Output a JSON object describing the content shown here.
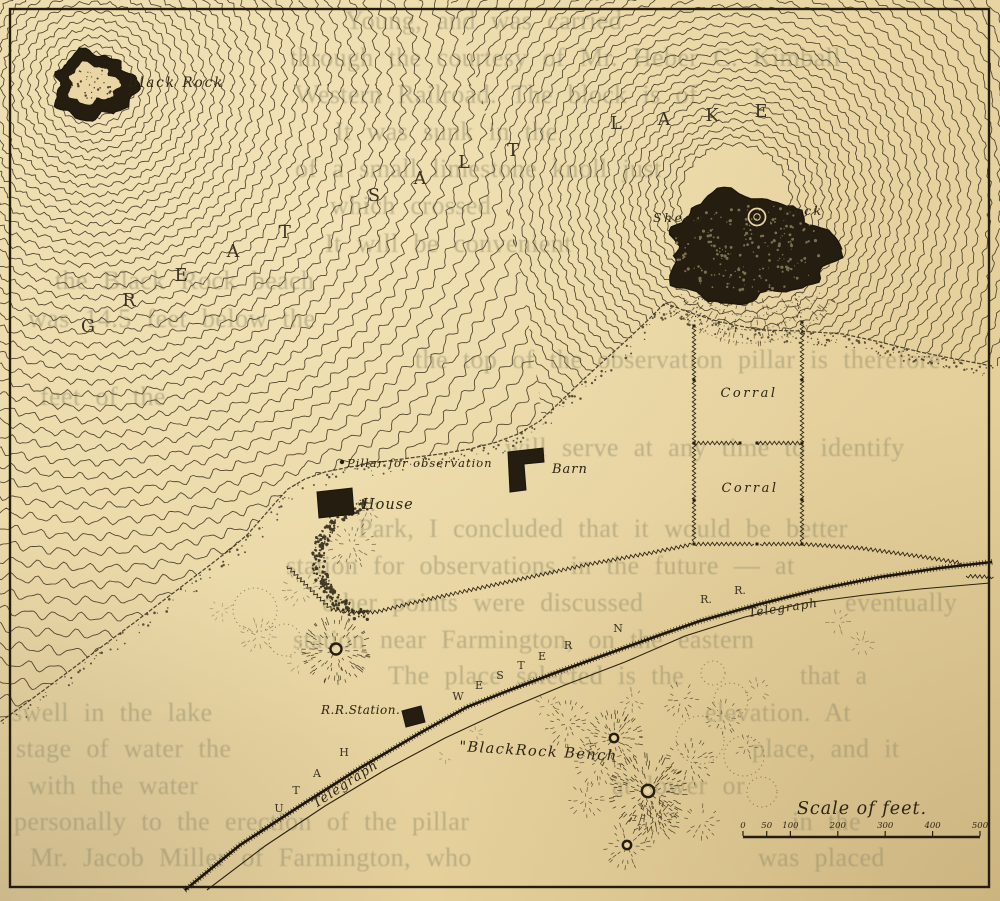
{
  "map": {
    "lake_name": "GREAT SALT LAKE",
    "labels": {
      "black_rock": "Black Rock",
      "sheep_rock_left": "Sheep",
      "sheep_rock_right": "Rock",
      "corral_upper": "Corral",
      "corral_lower": "Corral",
      "pillar": "Pillar for observation",
      "barn": "Barn",
      "house": "House",
      "rr_station": "R.R.Station.",
      "railroad_name": "UTAH WESTERN R.R.",
      "telegraph_lower": "Telegraph",
      "telegraph_upper": "Telegraph",
      "black_rock_bench": "\"BlackRock Bench",
      "scale_title": "Scale of feet."
    },
    "scale_bar": {
      "tick_labels": [
        "0",
        "50",
        "100",
        "200",
        "300",
        "400",
        "500"
      ]
    },
    "colors": {
      "paper": "#e9d6a4",
      "ink": "#38301f",
      "ghost_text": "#8f8a68"
    }
  },
  "bleedthrough_text": [
    {
      "x": 345,
      "y": 6,
      "text": "Young, and was carried"
    },
    {
      "x": 290,
      "y": 43,
      "text": "through the courtesy of Mr. Heber C. Kimball"
    },
    {
      "x": 295,
      "y": 80,
      "text": "Western Railroad.  The block is of"
    },
    {
      "x": 335,
      "y": 117,
      "text": "It was sunk in the"
    },
    {
      "x": 295,
      "y": 154,
      "text": "of a small limestone knoll just"
    },
    {
      "x": 330,
      "y": 191,
      "text": "which crossed"
    },
    {
      "x": 325,
      "y": 229,
      "text": "It will be convenient"
    },
    {
      "x": 55,
      "y": 266,
      "text": "the Black Rock beach"
    },
    {
      "x": 28,
      "y": 304,
      "text": "was 14.5 feet below the"
    },
    {
      "x": 415,
      "y": 345,
      "text": "the top of the observation pillar is therefore"
    },
    {
      "x": 40,
      "y": 382,
      "text": "feet of the"
    },
    {
      "x": 505,
      "y": 433,
      "text": "will serve at any time to identify"
    },
    {
      "x": 358,
      "y": 514,
      "text": "Park, I concluded that it would be better"
    },
    {
      "x": 286,
      "y": 551,
      "text": "station for observations in the future — at"
    },
    {
      "x": 322,
      "y": 588,
      "text": "other points were discussed"
    },
    {
      "x": 845,
      "y": 588,
      "text": "eventually"
    },
    {
      "x": 293,
      "y": 625,
      "text": "station near Farmington, on the eastern"
    },
    {
      "x": 388,
      "y": 661,
      "text": "The place selected is the"
    },
    {
      "x": 800,
      "y": 661,
      "text": "that a"
    },
    {
      "x": 12,
      "y": 698,
      "text": "swell in the lake"
    },
    {
      "x": 705,
      "y": 698,
      "text": "elevation.  At"
    },
    {
      "x": 16,
      "y": 734,
      "text": "stage of water the"
    },
    {
      "x": 752,
      "y": 734,
      "text": "place, and it"
    },
    {
      "x": 28,
      "y": 771,
      "text": "with the water"
    },
    {
      "x": 612,
      "y": 771,
      "text": "at lower or"
    },
    {
      "x": 14,
      "y": 807,
      "text": "personally to the erection of the pillar"
    },
    {
      "x": 792,
      "y": 807,
      "text": "in the"
    },
    {
      "x": 30,
      "y": 843,
      "text": "Mr. Jacob Miller of Farmington, who"
    },
    {
      "x": 758,
      "y": 843,
      "text": "was placed"
    }
  ]
}
